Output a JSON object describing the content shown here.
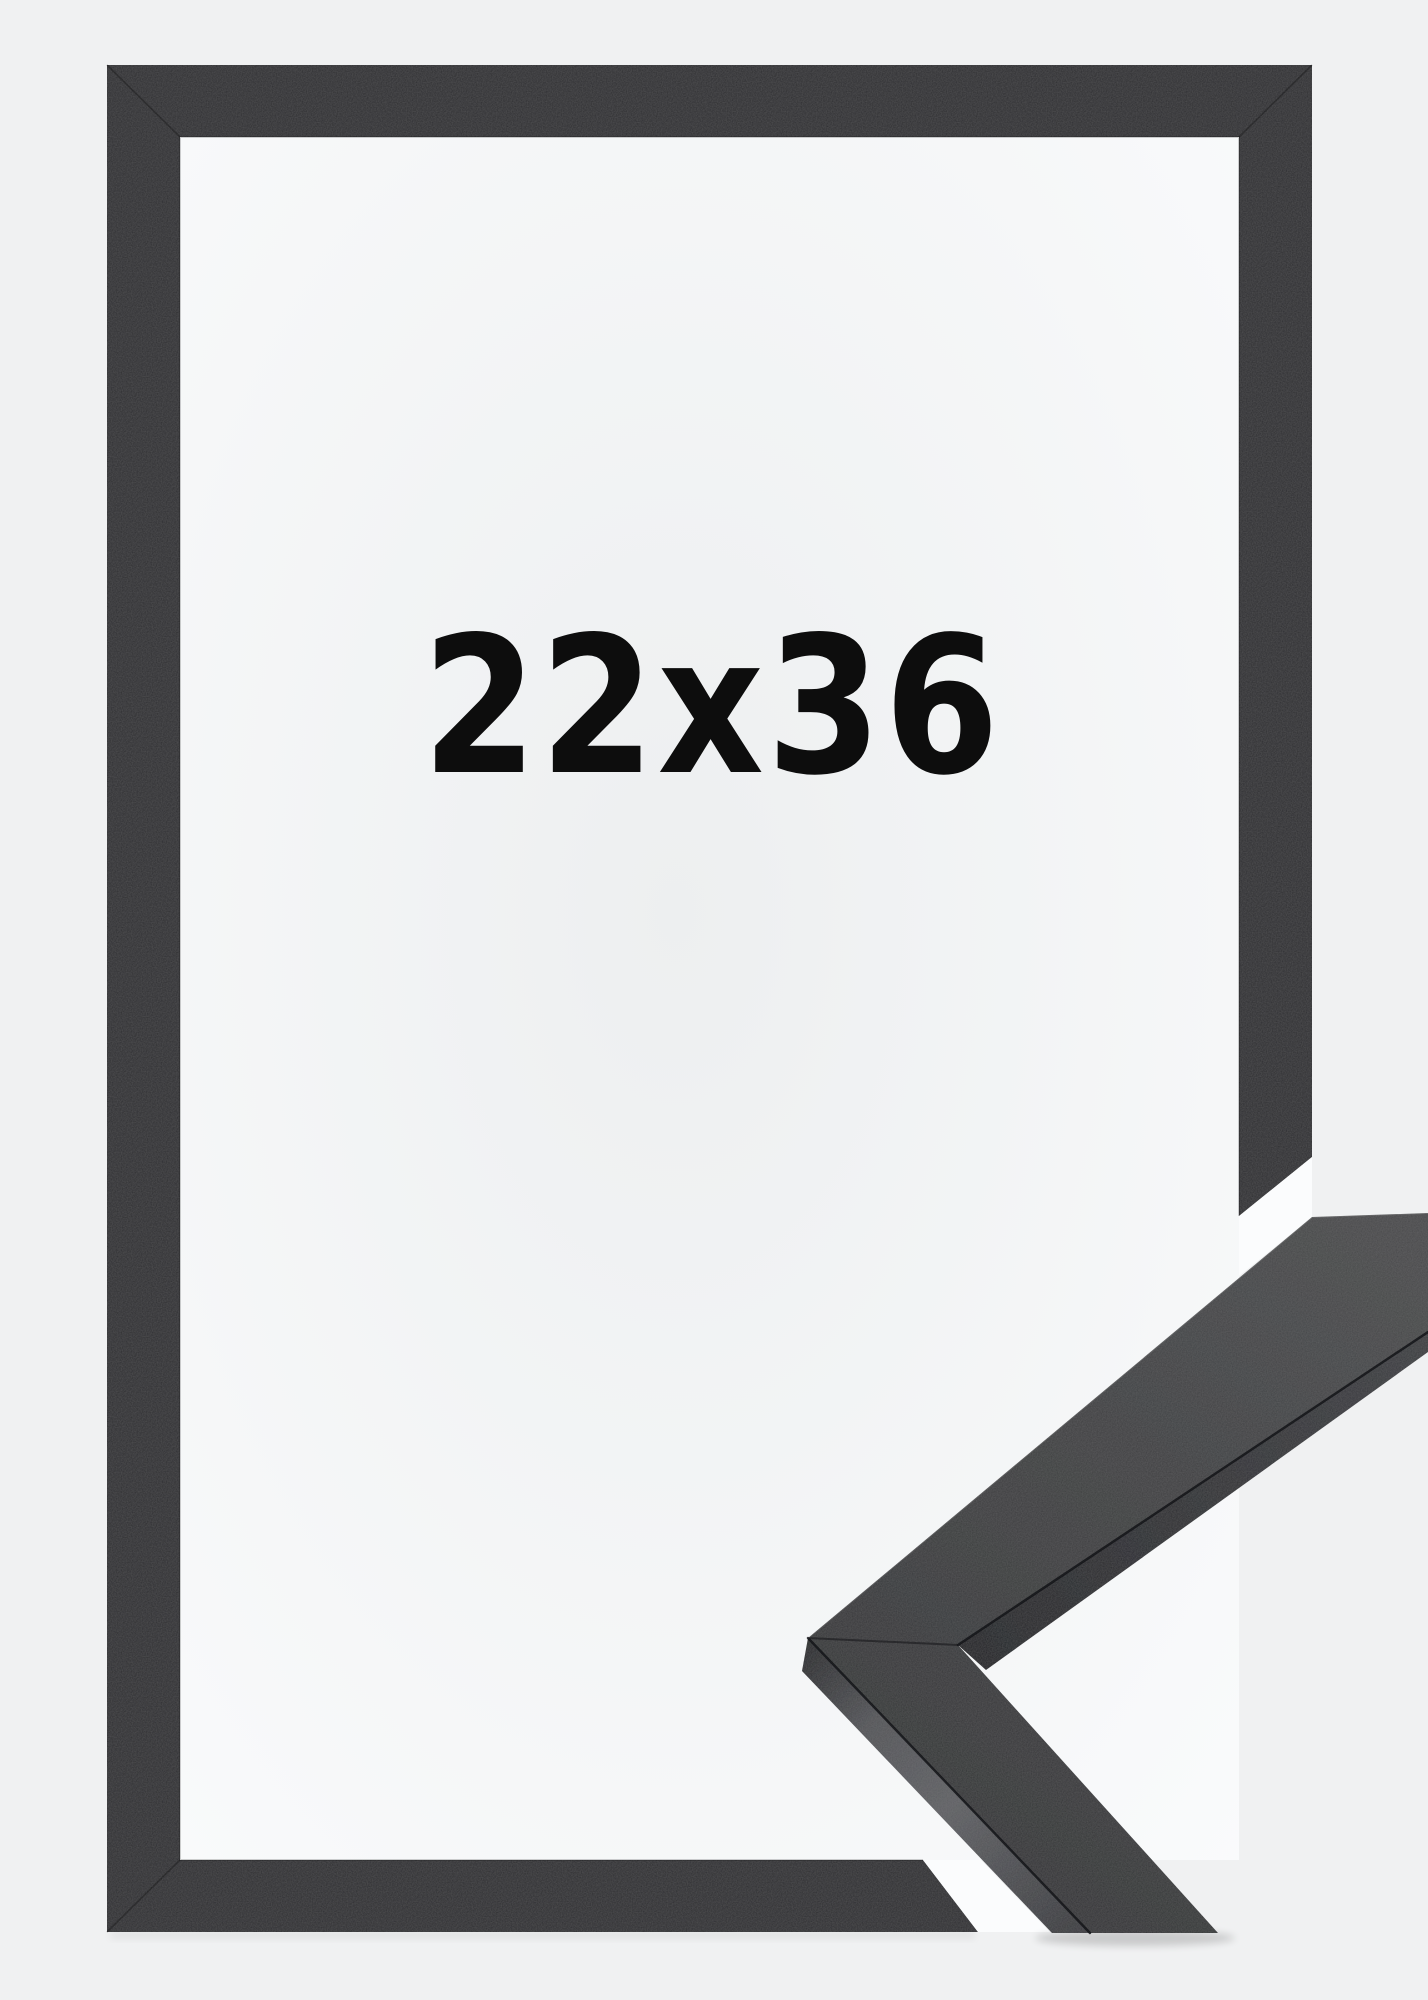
{
  "product_image": {
    "size_label": "22x36"
  },
  "colors": {
    "background": "#f0f1f2",
    "interior-center": "#edeff0",
    "interior-edge": "#fafbfc",
    "frame-face": "#2e2f31",
    "sample-face-light": "#48494b",
    "sample-face-dark": "#353638",
    "sample-side-light": "#5e5f63",
    "sample-side-dark": "#28292c",
    "gap-white": "#fbfcfd",
    "text": "#0d0d0d"
  }
}
